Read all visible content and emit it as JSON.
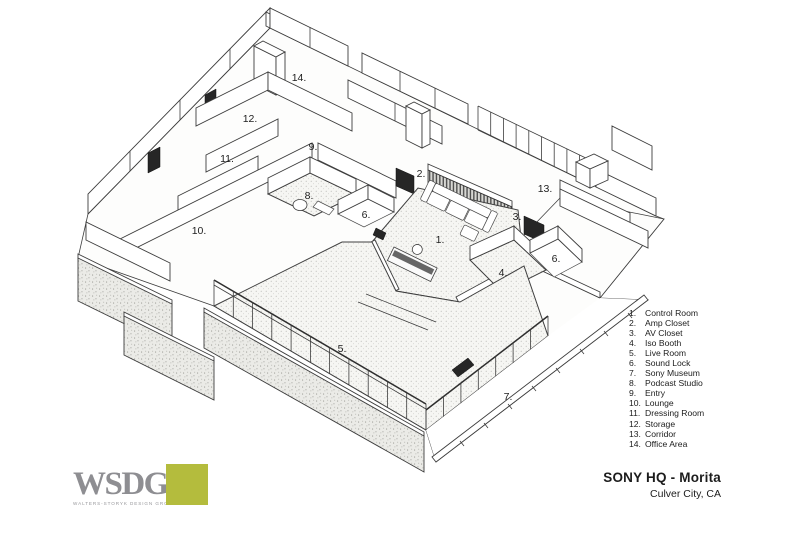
{
  "header": {
    "title": "SONY HQ - Morita",
    "subtitle": "Culver City, CA"
  },
  "logo": {
    "wordmark": "WSDG",
    "gmark": "”",
    "tagline": "WALTERS-STORYK DESIGN GROUP",
    "accent_color": "#b4bc3d"
  },
  "legend": {
    "items": [
      {
        "num": "1.",
        "label": "Control Room"
      },
      {
        "num": "2.",
        "label": "Amp Closet"
      },
      {
        "num": "3.",
        "label": "AV Closet"
      },
      {
        "num": "4.",
        "label": "Iso Booth"
      },
      {
        "num": "5.",
        "label": "Live Room"
      },
      {
        "num": "6.",
        "label": "Sound Lock"
      },
      {
        "num": "7.",
        "label": "Sony Museum"
      },
      {
        "num": "8.",
        "label": "Podcast Studio"
      },
      {
        "num": "9.",
        "label": "Entry"
      },
      {
        "num": "10.",
        "label": "Lounge"
      },
      {
        "num": "11.",
        "label": "Dressing Room"
      },
      {
        "num": "12.",
        "label": "Storage"
      },
      {
        "num": "13.",
        "label": "Corridor"
      },
      {
        "num": "14.",
        "label": "Office Area"
      }
    ]
  },
  "plan": {
    "drawing_type": "isometric floor plan",
    "labels": [
      {
        "num": "1.",
        "room": "Control Room",
        "x": 440,
        "y": 243
      },
      {
        "num": "2.",
        "room": "Amp Closet",
        "x": 421,
        "y": 177
      },
      {
        "num": "3.",
        "room": "AV Closet",
        "x": 517,
        "y": 220
      },
      {
        "num": "4.",
        "room": "Iso Booth",
        "x": 503,
        "y": 276
      },
      {
        "num": "5.",
        "room": "Live Room",
        "x": 342,
        "y": 352
      },
      {
        "num": "6.",
        "room": "Sound Lock",
        "x": 366,
        "y": 218
      },
      {
        "num": "6.",
        "room": "Sound Lock",
        "x": 556,
        "y": 262
      },
      {
        "num": "7.",
        "room": "Sony Museum",
        "x": 508,
        "y": 400
      },
      {
        "num": "8.",
        "room": "Podcast Studio",
        "x": 309,
        "y": 199
      },
      {
        "num": "9.",
        "room": "Entry",
        "x": 313,
        "y": 150
      },
      {
        "num": "10.",
        "room": "Lounge",
        "x": 199,
        "y": 234
      },
      {
        "num": "11.",
        "room": "Dressing Room",
        "x": 227,
        "y": 162
      },
      {
        "num": "12.",
        "room": "Storage",
        "x": 250,
        "y": 122
      },
      {
        "num": "13.",
        "room": "Corridor",
        "x": 545,
        "y": 192
      },
      {
        "num": "14.",
        "room": "Office Area",
        "x": 299,
        "y": 81
      }
    ]
  }
}
